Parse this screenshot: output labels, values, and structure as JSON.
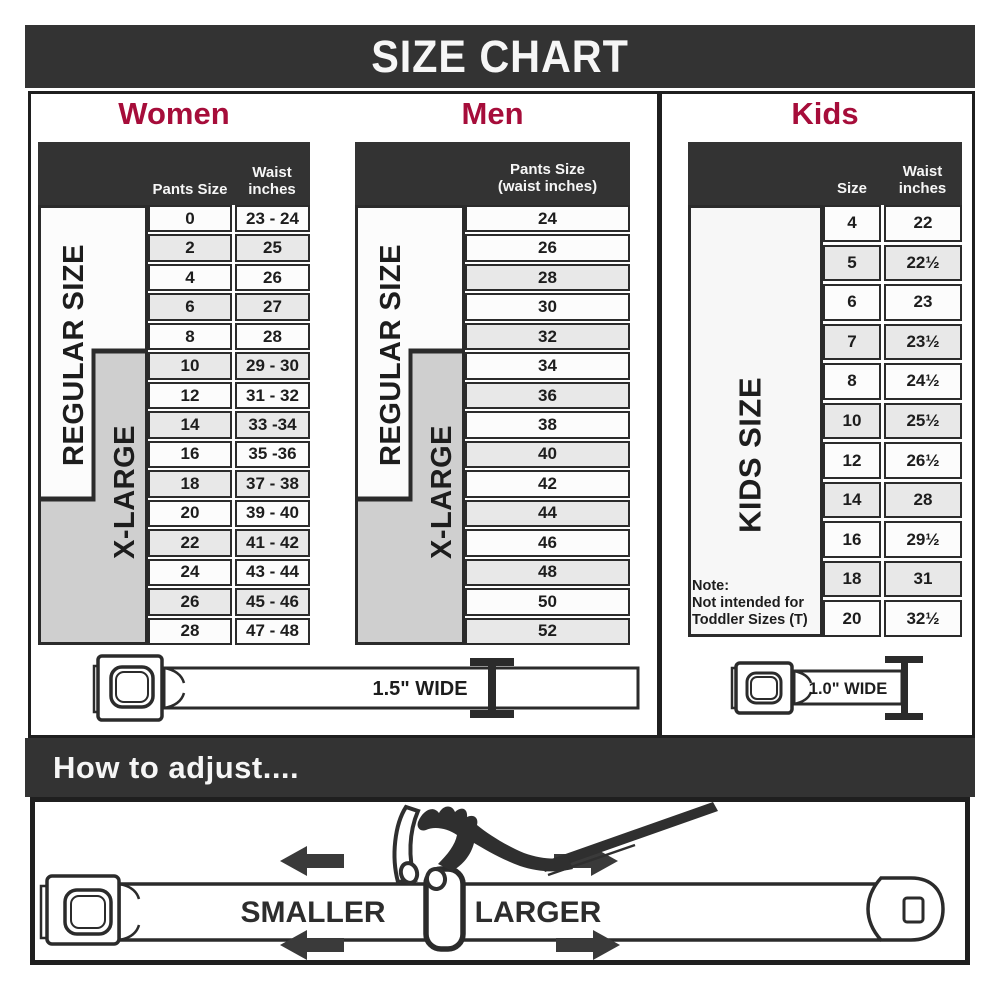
{
  "title": "SIZE CHART",
  "theme": {
    "accent_red": "#a60d3a",
    "charcoal": "#333333",
    "table_border": "#2b2b2b",
    "shaded_row": "#e8e8e8",
    "plain_row": "#fcfcfc",
    "xlarge_gray": "#cfcfcf"
  },
  "women": {
    "heading": "Women",
    "header_size": "Pants Size",
    "header_waist_line1": "Waist",
    "header_waist_line2": "inches",
    "label_regular": "REGULAR SIZE",
    "label_xlarge": "X-LARGE",
    "rows": [
      {
        "size": "0",
        "waist": "23 - 24",
        "shaded": false
      },
      {
        "size": "2",
        "waist": "25",
        "shaded": true
      },
      {
        "size": "4",
        "waist": "26",
        "shaded": false
      },
      {
        "size": "6",
        "waist": "27",
        "shaded": true
      },
      {
        "size": "8",
        "waist": "28",
        "shaded": false
      },
      {
        "size": "10",
        "waist": "29 - 30",
        "shaded": true
      },
      {
        "size": "12",
        "waist": "31 - 32",
        "shaded": false
      },
      {
        "size": "14",
        "waist": "33 -34",
        "shaded": true
      },
      {
        "size": "16",
        "waist": "35 -36",
        "shaded": false
      },
      {
        "size": "18",
        "waist": "37 - 38",
        "shaded": true
      },
      {
        "size": "20",
        "waist": "39 - 40",
        "shaded": false
      },
      {
        "size": "22",
        "waist": "41 - 42",
        "shaded": true
      },
      {
        "size": "24",
        "waist": "43 - 44",
        "shaded": false
      },
      {
        "size": "26",
        "waist": "45 - 46",
        "shaded": true
      },
      {
        "size": "28",
        "waist": "47 - 48",
        "shaded": false
      }
    ],
    "belt_label": "1.5\" WIDE"
  },
  "men": {
    "heading": "Men",
    "header_line1": "Pants Size",
    "header_line2": "(waist inches)",
    "label_regular": "REGULAR SIZE",
    "label_xlarge": "X-LARGE",
    "rows": [
      {
        "size": "24",
        "shaded": false
      },
      {
        "size": "26",
        "shaded": false
      },
      {
        "size": "28",
        "shaded": true
      },
      {
        "size": "30",
        "shaded": false
      },
      {
        "size": "32",
        "shaded": true
      },
      {
        "size": "34",
        "shaded": false
      },
      {
        "size": "36",
        "shaded": true
      },
      {
        "size": "38",
        "shaded": false
      },
      {
        "size": "40",
        "shaded": true
      },
      {
        "size": "42",
        "shaded": false
      },
      {
        "size": "44",
        "shaded": true
      },
      {
        "size": "46",
        "shaded": false
      },
      {
        "size": "48",
        "shaded": true
      },
      {
        "size": "50",
        "shaded": false
      },
      {
        "size": "52",
        "shaded": true
      }
    ]
  },
  "kids": {
    "heading": "Kids",
    "header_size": "Size",
    "header_waist_line1": "Waist",
    "header_waist_line2": "inches",
    "label": "KIDS SIZE",
    "note": [
      "Note:",
      "Not intended for",
      "Toddler Sizes (T)"
    ],
    "rows": [
      {
        "size": "4",
        "waist": "22",
        "shaded": false
      },
      {
        "size": "5",
        "waist": "22½",
        "shaded": true
      },
      {
        "size": "6",
        "waist": "23",
        "shaded": false
      },
      {
        "size": "7",
        "waist": "23½",
        "shaded": true
      },
      {
        "size": "8",
        "waist": "24½",
        "shaded": false
      },
      {
        "size": "10",
        "waist": "25½",
        "shaded": true
      },
      {
        "size": "12",
        "waist": "26½",
        "shaded": false
      },
      {
        "size": "14",
        "waist": "28",
        "shaded": true
      },
      {
        "size": "16",
        "waist": "29½",
        "shaded": false
      },
      {
        "size": "18",
        "waist": "31",
        "shaded": true
      },
      {
        "size": "20",
        "waist": "32½",
        "shaded": false
      }
    ],
    "belt_label": "1.0\" WIDE"
  },
  "adjust": {
    "heading": "How to adjust....",
    "smaller": "SMALLER",
    "larger": "LARGER"
  }
}
